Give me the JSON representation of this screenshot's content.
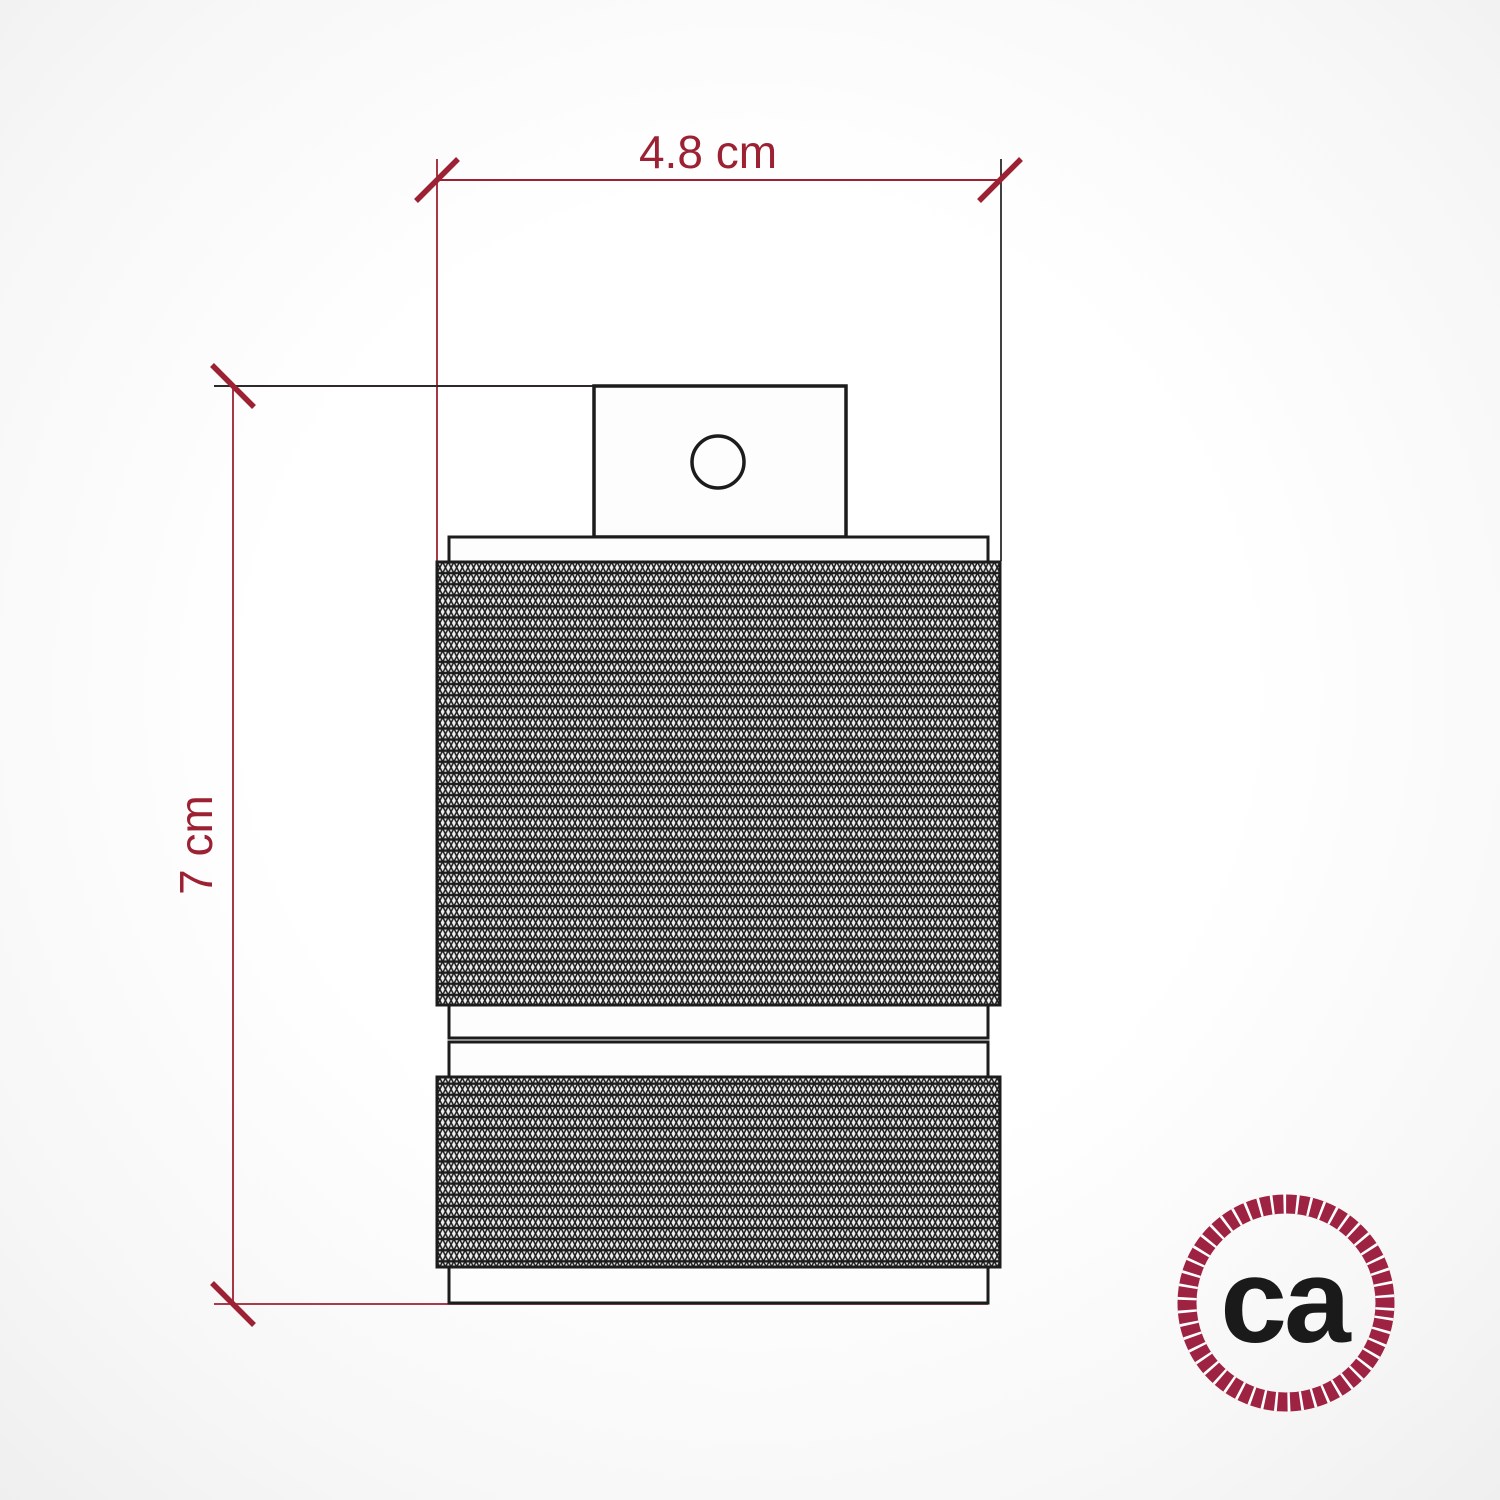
{
  "dimensions": {
    "width": {
      "label": "4.8 cm"
    },
    "height": {
      "label": "7 cm"
    }
  },
  "logo": {
    "text": "ca"
  },
  "colors": {
    "dimension_red": "#9c2133",
    "outline_black": "#1c1c1c",
    "extension_dark": "#2e2a2b",
    "logo_ring_red": "#9e2342",
    "logo_text_black": "#1a1a1a",
    "knurl_bg": "#efefef",
    "paper_white": "#fdfdfd"
  }
}
